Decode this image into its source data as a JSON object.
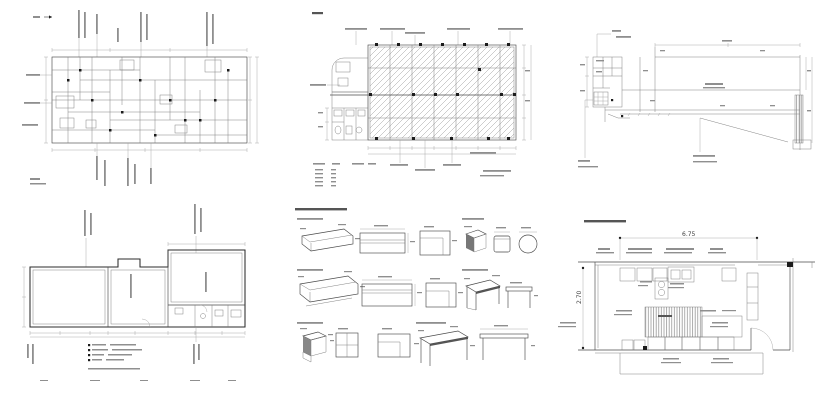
{
  "sheet": {
    "background_color": "#ffffff",
    "line_color": "#4a4a4a",
    "hatch_color": "#9a9a9a",
    "description": "grid of six scanned Japanese architectural CAD drawing thumbnails"
  },
  "panels": [
    {
      "name": "dimensioned floor plan with vertical callout notes"
    },
    {
      "name": "hatched ceiling-framing plan with column markers and legend table"
    },
    {
      "name": "light floor plan with leader notes and diagonal section line"
    },
    {
      "name": "long horizontal floor plan with finish legend"
    },
    {
      "name": "furniture detail drawings: benches, sofas, stools, chairs, tables"
    },
    {
      "name": "kitchen layout plan with hatched counter and door swing"
    }
  ],
  "kitchen": {
    "width_label": "6.75",
    "height_label": "2.70"
  }
}
